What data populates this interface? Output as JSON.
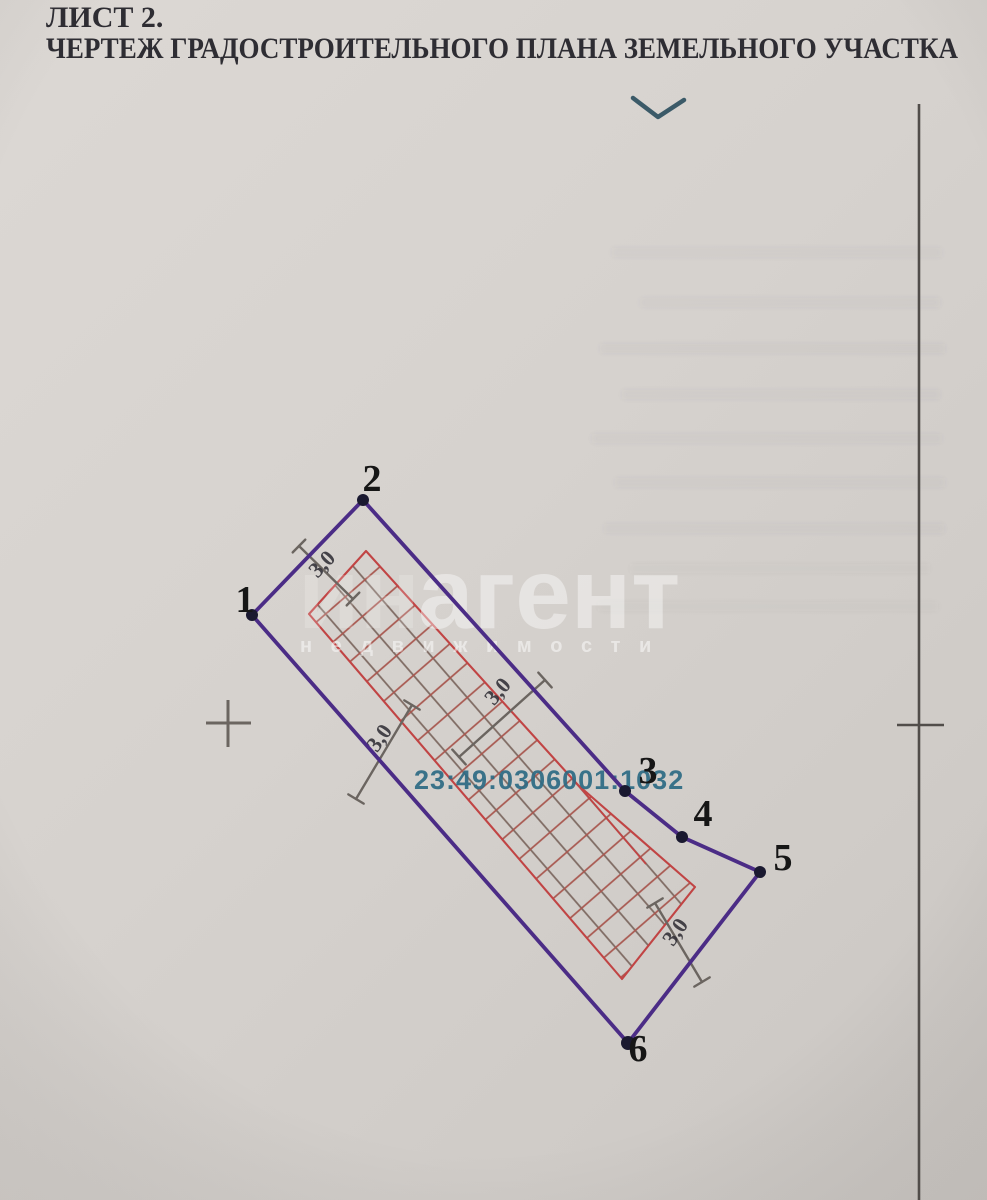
{
  "page": {
    "sheet_label": "ЛИСТ 2.",
    "title": "ЧЕРТЕЖ ГРАДОСТРОИТЕЛЬНОГО ПЛАНА ЗЕМЕЛЬНОГО УЧАСТКА"
  },
  "drawing": {
    "cadastral_number": "23:49:0306001:1032",
    "corner_labels": [
      "1",
      "2",
      "3",
      "4",
      "5",
      "6"
    ],
    "setback_labels": [
      "3,0",
      "3,0",
      "3,0",
      "3,0"
    ],
    "colors": {
      "title_ink": "#2e2d33",
      "boundary": "#4b2c86",
      "hatch_outline": "#c14444",
      "hatch_line_red": "#a8574f",
      "hatch_line_gray": "#7e6a62",
      "dimension": "#6b6560",
      "cadastral_text": "#2d6b84",
      "corner_dot": "#1a1930",
      "chevron": "#3b5a68",
      "ruler_line": "#514d4a"
    }
  },
  "watermark": {
    "prefix": "ин",
    "main": "агент",
    "subtitle": "н е д в и ж и м о с т и"
  }
}
